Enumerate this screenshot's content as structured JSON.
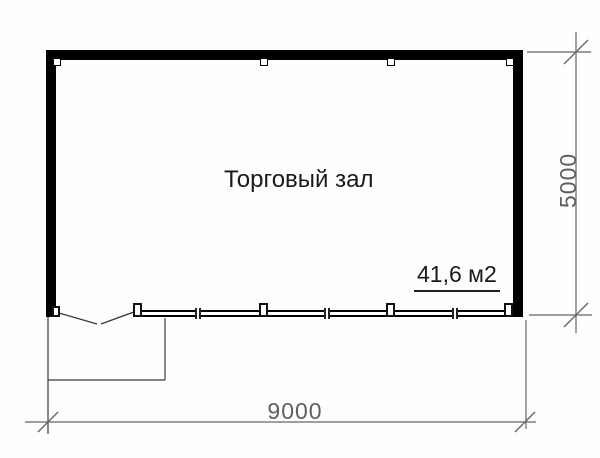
{
  "plan": {
    "room_label": "Торговый зал",
    "area_label": "41,6 м2",
    "dimensions": {
      "width_mm": "9000",
      "height_mm": "5000"
    },
    "colors": {
      "walls": "#000000",
      "thin_lines": "#3a3a3a",
      "dimension_lines": "#666666",
      "dimension_text": "#5f5f5f",
      "background": "#fefefe"
    }
  }
}
